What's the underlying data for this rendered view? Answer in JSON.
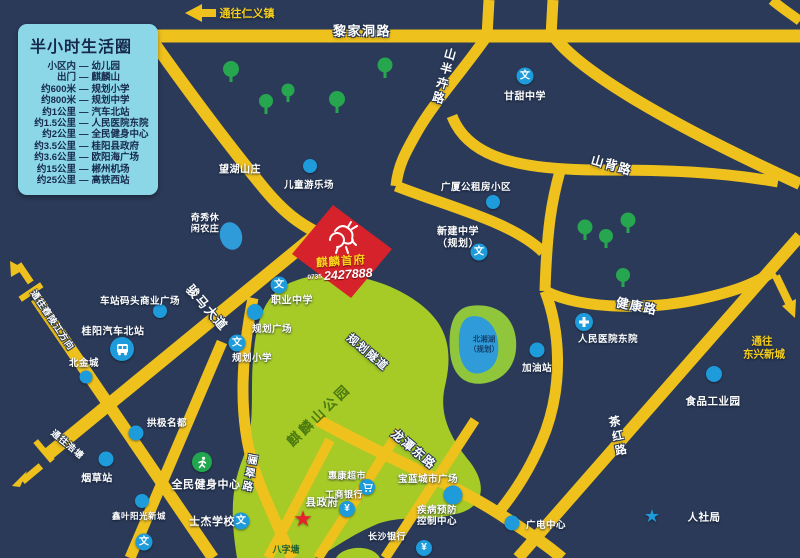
{
  "colors": {
    "bg": "#2b3a58",
    "road": "#eec11d",
    "park": "#a6cb27",
    "tree": "#27a650",
    "poi_blue": "#1e9bdb",
    "legend_bg": "#8bd7e7",
    "project_red": "#d6222b",
    "lake_blue": "#2f9cd9",
    "lake_green": "#8fc63c"
  },
  "legend": {
    "title": "半小时生活圈",
    "dash": "—",
    "items": [
      {
        "from": "小区内",
        "to": "幼儿园"
      },
      {
        "from": "出门",
        "to": "麒麟山"
      },
      {
        "from": "约600米",
        "to": "规划小学"
      },
      {
        "from": "约800米",
        "to": "规划中学"
      },
      {
        "from": "约1公里",
        "to": "汽车北站"
      },
      {
        "from": "约1.5公里",
        "to": "人民医院东院"
      },
      {
        "from": "约2公里",
        "to": "全民健身中心"
      },
      {
        "from": "约3.5公里",
        "to": "桂阳县政府"
      },
      {
        "from": "约3.6公里",
        "to": "欧阳海广场"
      },
      {
        "from": "约15公里",
        "to": "郴州机场"
      },
      {
        "from": "约25公里",
        "to": "高铁西站"
      }
    ]
  },
  "roads": {
    "lijiadong": "黎家洞路",
    "shanbanhui": "山半卉路",
    "shanbei": "山背路",
    "jiankang": "健康路",
    "junma": "骏马大道",
    "longtandong": "龙潭东路",
    "chahong": "茶红路",
    "guihua_suidao": "规划隧道",
    "licui": "骊翠路"
  },
  "directions": {
    "renyi": "通往仁义镇",
    "chongling": "通往舂陵江方向",
    "haotang": "通往浩塘",
    "dongxing_line1": "通往",
    "dongxing_line2": "东兴新城"
  },
  "project": {
    "name": "麒麟首府",
    "phone_prefix": "0735",
    "phone": "2427888"
  },
  "park": {
    "name": "麒麟山公园",
    "pond": "八字塘"
  },
  "lake": {
    "name": "北湘湖",
    "note": "（规划）"
  },
  "pois": {
    "wanghu": "望湖山庄",
    "ertong": "儿童游乐场",
    "qixiu_l1": "奇秀休",
    "qixiu_l2": "闲农庄",
    "guangsha": "广厦公租房小区",
    "gantian": "甘甜中学",
    "xinjian_l1": "新建中学",
    "xinjian_l2": "（规划）",
    "chezhan": "车站码头商业广场",
    "qichebeizhan": "桂阳汽车北站",
    "beijincheng": "北金城",
    "zhiye": "职业中学",
    "guihua_guangchang": "规划广场",
    "guihua_xiaoxue": "规划小学",
    "yancao": "烟草站",
    "gongji": "拱极名都",
    "quanmin": "全民健身中心",
    "xinye": "鑫叶阳光新城",
    "shijie": "士杰学校",
    "xianzhengfu": "县政府",
    "huikang": "惠康超市",
    "gongshang": "工商银行",
    "baolan": "宝蓝城市广场",
    "jibing_l1": "疾病预防",
    "jibing_l2": "控制中心",
    "changsha": "长沙银行",
    "guangdian": "广电中心",
    "renshe": "人社局",
    "shipin": "食品工业园",
    "jiayou": "加油站",
    "renmin": "人民医院东院"
  },
  "icons": {
    "school": "文",
    "bank": "¥",
    "star": "★"
  }
}
